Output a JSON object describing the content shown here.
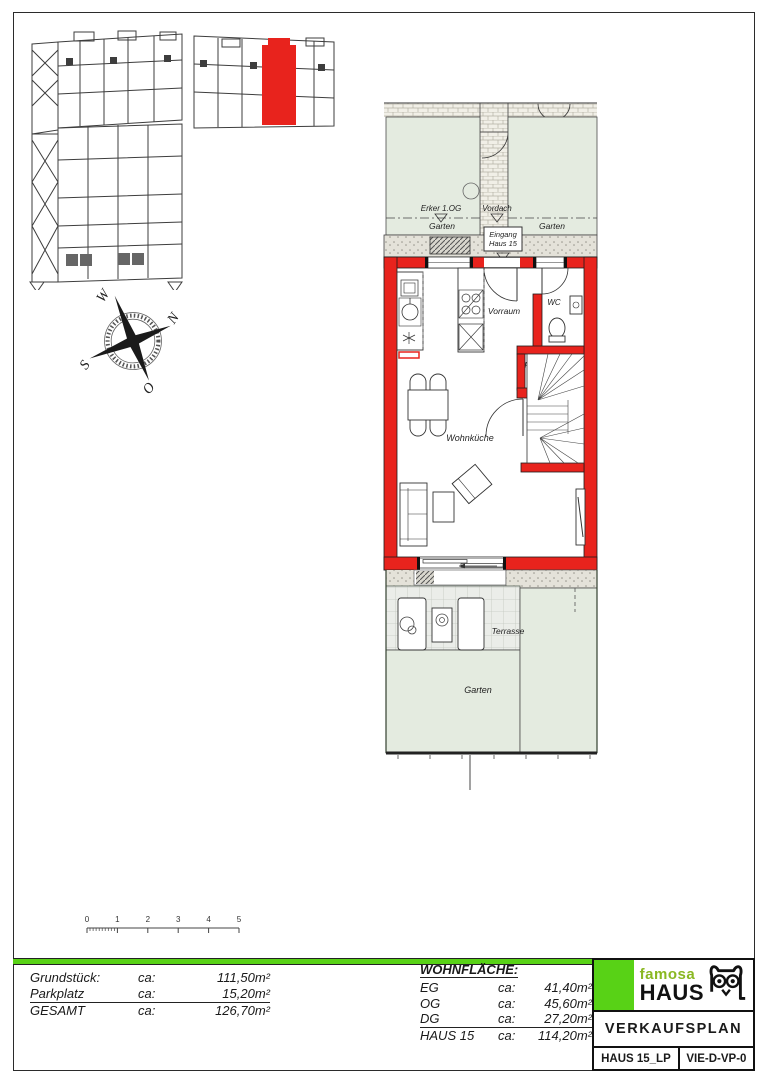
{
  "plan": {
    "erker": "Erker 1.OG",
    "vordach": "Vordach",
    "garten": "Garten",
    "eingang1": "Eingang",
    "eingang2": "Haus 15",
    "vorraum": "Vorraum",
    "wc": "WC",
    "podest": "Podest",
    "wohnkueche": "Wohnküche",
    "terrasse": "Terrasse"
  },
  "compass": {
    "n": "N",
    "o": "O",
    "s": "S",
    "w": "W"
  },
  "scale": {
    "t0": "0",
    "t1": "1",
    "t2": "2",
    "t3": "3",
    "t4": "4",
    "t5": "5"
  },
  "areas": {
    "left": [
      {
        "label": "Grundstück:",
        "ca": "ca:",
        "value": "111,50m²"
      },
      {
        "label": "Parkplatz",
        "ca": "ca:",
        "value": "15,20m²"
      },
      {
        "label": "GESAMT",
        "ca": "ca:",
        "value": "126,70m²"
      }
    ],
    "wohnflaeche_title": "WOHNFLÄCHE:",
    "wohnflaeche": [
      {
        "label": "EG",
        "ca": "ca:",
        "value": "41,40m²"
      },
      {
        "label": "OG",
        "ca": "ca:",
        "value": "45,60m²"
      },
      {
        "label": "DG",
        "ca": "ca:",
        "value": "27,20m²"
      },
      {
        "label": "HAUS 15",
        "ca": "ca:",
        "value": "114,20m²"
      }
    ]
  },
  "titleblock": {
    "brand_top": "famosa",
    "brand_bottom": "HAUS",
    "plan_title": "VERKAUFSPLAN",
    "doc_id": "HAUS 15_LP",
    "doc_code": "VIE-D-VP-0"
  },
  "colors": {
    "wall_red": "#e8231d",
    "brand_green": "#58d216",
    "leaf_green": "#8ab822",
    "garden_green": "#e4ebe0"
  }
}
